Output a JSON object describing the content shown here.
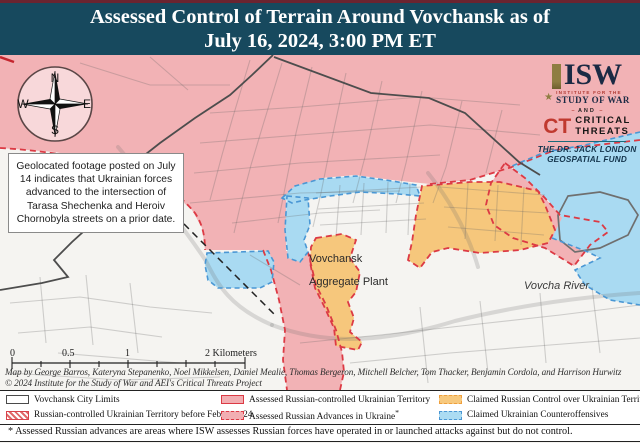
{
  "titlebar": {
    "line1": "Assessed Control of Terrain Around Vovchansk as of",
    "line2": "July 16, 2024, 3:00 PM ET"
  },
  "colors": {
    "header_bg": "#17495e",
    "russian_controlled_fill": "#f2b2b5",
    "russian_border": "#dc3a44",
    "claimed_russian_fill": "#f6c77c",
    "claimed_russian_border": "#ef9f3d",
    "claimed_ukrainian_fill": "#a9daf2",
    "claimed_ukrainian_border": "#4a97d4",
    "city_limits_line": "#4d4d4d"
  },
  "compass": {
    "n": "N",
    "e": "E",
    "s": "S",
    "w": "W"
  },
  "annotation": {
    "text": "Geolocated footage posted on July 14 indicates that Ukrainian forces advanced to the intersection of Tarasa Shechenka and Heroiv Chornobyla streets on a prior date."
  },
  "logos": {
    "isw_acronym": "ISW",
    "star": "★",
    "isw_line1": "INSTITUTE FOR THE",
    "isw_line2": "STUDY OF WAR",
    "and_label": "AND",
    "ct_acronym": "CT",
    "ct_line1": "CRITICAL",
    "ct_line2": "THREATS",
    "fund_line1": "THE DR. JACK LONDON",
    "fund_line2": "GEOSPATIAL FUND"
  },
  "map_labels": {
    "plant_line1": "Vovchansk",
    "plant_line2": "Aggregate Plant",
    "river": "Vovcha River"
  },
  "scalebar": {
    "t0": "0",
    "t05": "0.5",
    "t1": "1",
    "t2": "2 Kilometers"
  },
  "credits": {
    "line1": "Map by George Barros, Kateryna Stepanenko, Noel Mikkelsen, Daniel Mealie, Thomas Bergeron, Mitchell Belcher, Tom Thacker, Benjamin Cordola, and Harrison Hurwitz",
    "line2": "© 2024 Institute for the Study of War and AEI's Critical Threats Project"
  },
  "legend": {
    "asterisk": "*",
    "items": [
      {
        "label": "Vovchansk City Limits",
        "style": "city"
      },
      {
        "label": "Russian-controlled Ukrainian Territory before February 24",
        "style": "prewar"
      },
      {
        "label": "Assessed Russian-controlled Ukrainian Territory",
        "style": "assessed"
      },
      {
        "label": "Assessed Russian Advances in Ukraine",
        "style": "advance"
      },
      {
        "label": "Claimed Russian Control over Ukrainian Territory",
        "style": "claimed-rus"
      },
      {
        "label": "Claimed Ukrainian Counteroffensives",
        "style": "claimed-ukr"
      }
    ]
  },
  "footnote": {
    "text": "* Assessed Russian advances are areas where ISW assesses Russian forces have operated in or launched attacks against but do not control."
  }
}
